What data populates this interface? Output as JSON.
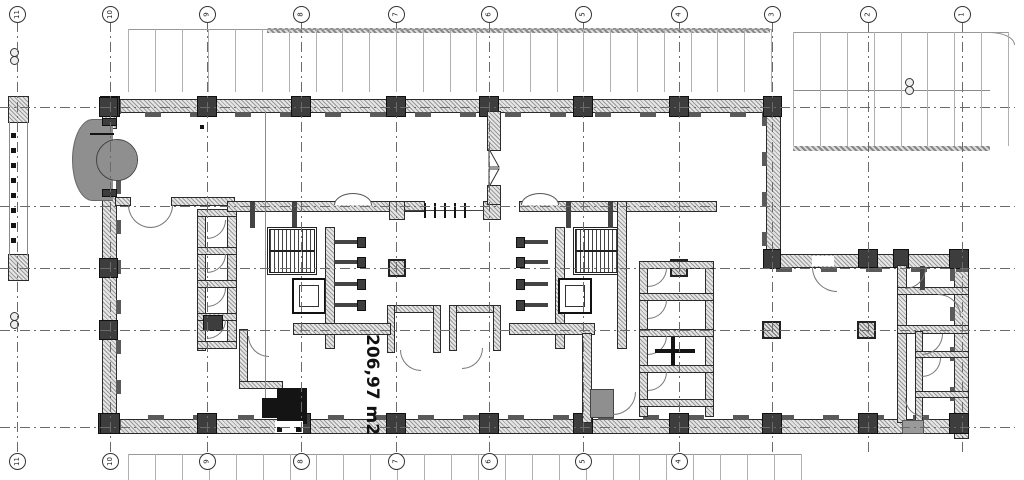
{
  "drawing": {
    "type": "architectural-floor-plan",
    "area": {
      "label": "206,97 m2"
    }
  },
  "grid": {
    "labels": [
      "11",
      "10",
      "9",
      "8",
      "7",
      "6",
      "5",
      "4",
      "3",
      "2",
      "1"
    ],
    "x": [
      17,
      110,
      207,
      301,
      396,
      489,
      583,
      679,
      772,
      868,
      962
    ],
    "top_bubble_y": 6,
    "bottom_bubble_y": 453,
    "bottom_count": 8,
    "h_lines_y": [
      107,
      206,
      268,
      330,
      427
    ]
  },
  "parking": {
    "rows": [
      {
        "name": "parking-row-top",
        "x": 128,
        "y": 29,
        "w": 643,
        "h": 63,
        "count": 24
      },
      {
        "name": "parking-lot-top-right",
        "x": 793,
        "y": 32,
        "w": 215,
        "h": 114,
        "count": 8
      },
      {
        "name": "parking-row-bottom",
        "x": 128,
        "y": 454,
        "w": 673,
        "h": 26,
        "count": 25
      }
    ]
  },
  "colors": {
    "line": "#2b2b2b",
    "wall_hatch": "#9a9a9a",
    "gray_fill": "#8f8f8f",
    "black_fill": "#141414",
    "grid_line": "#6a6a6a"
  }
}
